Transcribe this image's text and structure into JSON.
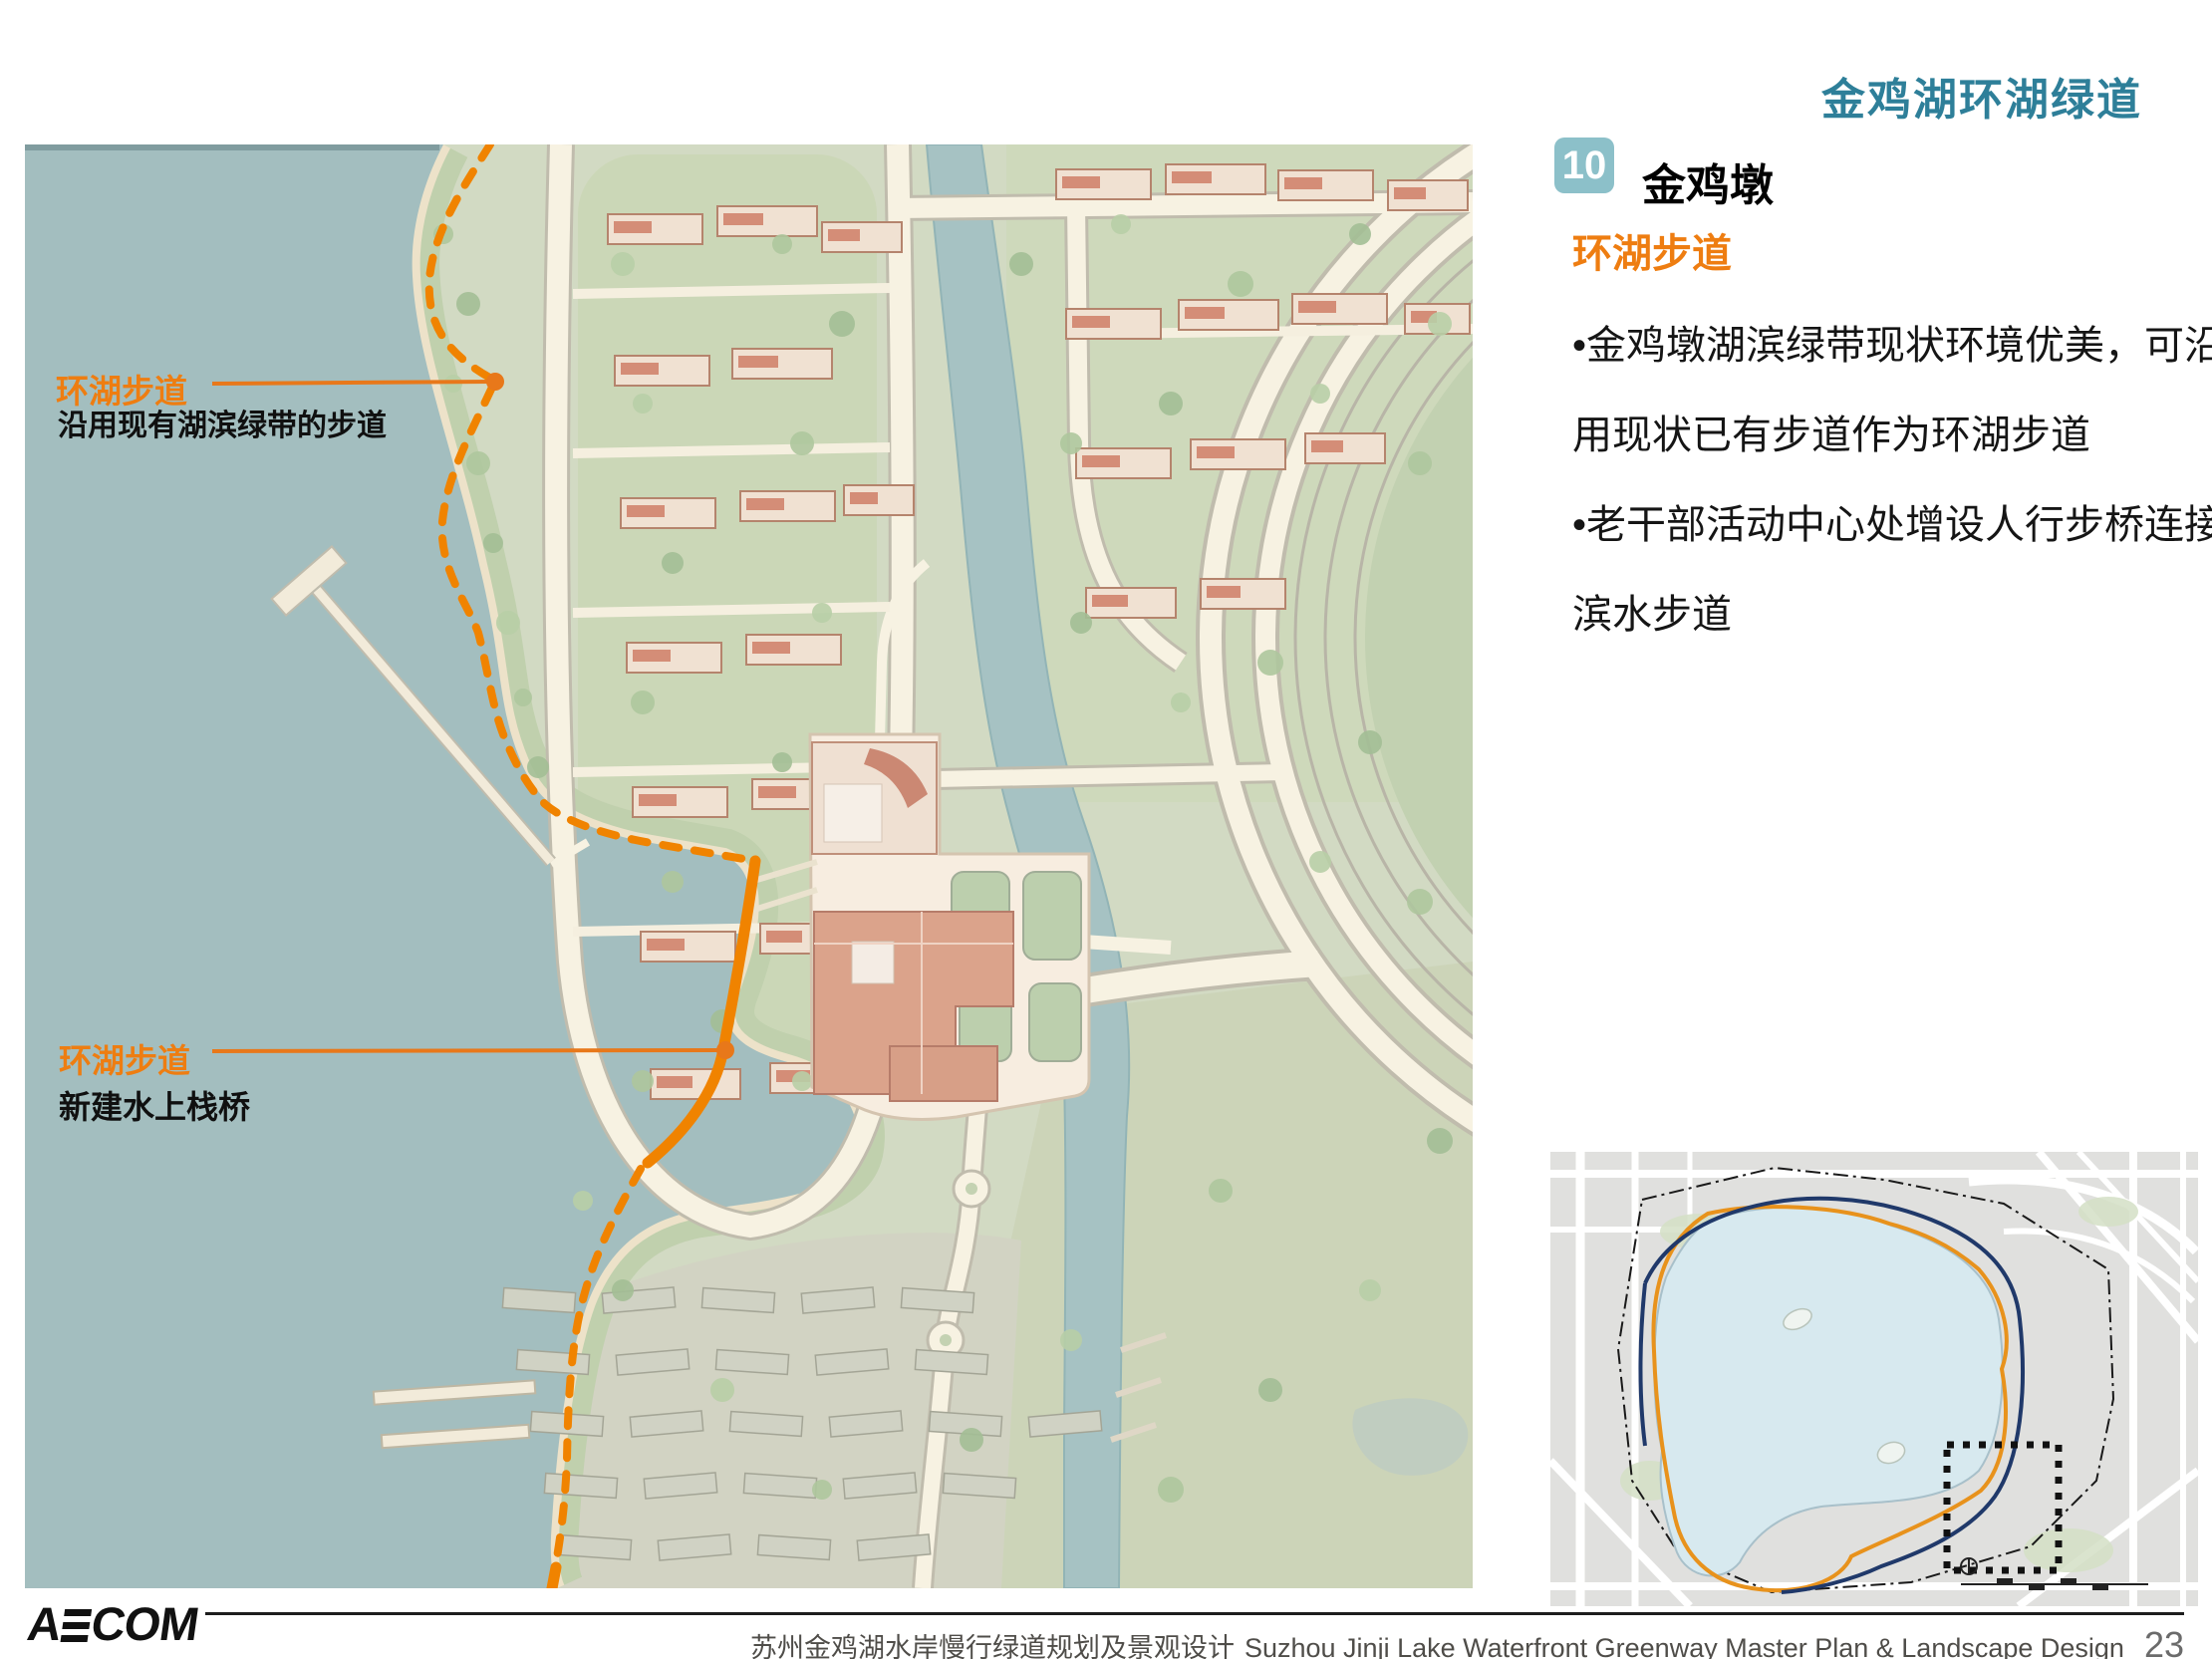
{
  "header": {
    "title": "金鸡湖环湖绿道"
  },
  "section": {
    "number": "10",
    "name": "金鸡墩",
    "subheading": "环湖步道",
    "bullets": [
      "•金鸡墩湖滨绿带现状环境优美，可沿",
      "用现状已有步道作为环湖步道",
      "•老干部活动中心处增设人行步桥连接",
      "滨水步道"
    ]
  },
  "map": {
    "annotations": [
      {
        "label": "环湖步道",
        "sublabel": "沿用现有湖滨绿带的步道"
      },
      {
        "label": "环湖步道",
        "sublabel": "新建水上栈桥"
      }
    ]
  },
  "footer": {
    "logo": "AECOM",
    "project_zh": "苏州金鸡湖水岸慢行绿道规划及景观设计",
    "project_en": "Suzhou Jinji Lake Waterfront Greenway  Master Plan & Landscape Design",
    "page": "23"
  },
  "colors": {
    "title_teal": "#2e7f99",
    "badge_teal": "#8cc0c9",
    "accent_orange": "#ee7d11",
    "route_orange": "#f08300",
    "navy_route": "#20396a",
    "lake_water": "#8fb0b1"
  }
}
